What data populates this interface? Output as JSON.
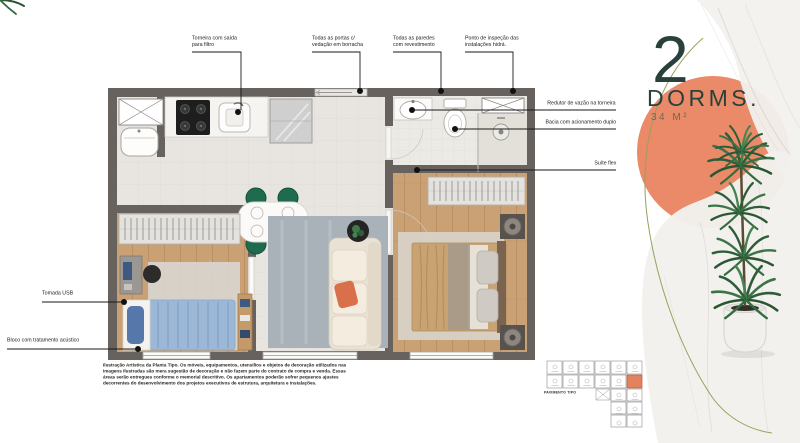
{
  "badge": {
    "number": "2",
    "label": "DORMS.",
    "area": "34 M²"
  },
  "annotations": {
    "top": [
      {
        "text": "Torneira com saída\npara filtro"
      },
      {
        "text": "Todas as portas c/\nvedação em borracha"
      },
      {
        "text": "Todas as paredes\ncom revestimento"
      },
      {
        "text": "Ponto de inspeção das\ninstalações hidrá."
      }
    ],
    "right": [
      {
        "text": "Redutor de vazão na torneira"
      },
      {
        "text": "Bacia com acionamento duplo"
      },
      {
        "text": "Suíte flex"
      }
    ],
    "left": [
      {
        "text": "Tomada USB"
      },
      {
        "text": "Bloco com tratamento acústico"
      }
    ]
  },
  "disclaimer": "Ilustração Artística da Planta Tipo. Os móveis, equipamentos, utensílios e objetos de decoração utilizados nas imagens ilustradas são mera sugestão de decoração e não fazem parte do contrato de compra e venda. Essas áreas serão entregues conforme o memorial descritivo. Os apartamentos poderão sofrer pequenos ajustes decorrentes do desenvolvimento dos projetos executivos de estrutura, arquitetura e instalações.",
  "keyplate": {
    "caption": "PAVIMENTO TIPO"
  },
  "colors": {
    "accent": "#EA8A68",
    "walls": "#67625E",
    "title": "#29413A",
    "olive_line": "#9AA05B"
  }
}
